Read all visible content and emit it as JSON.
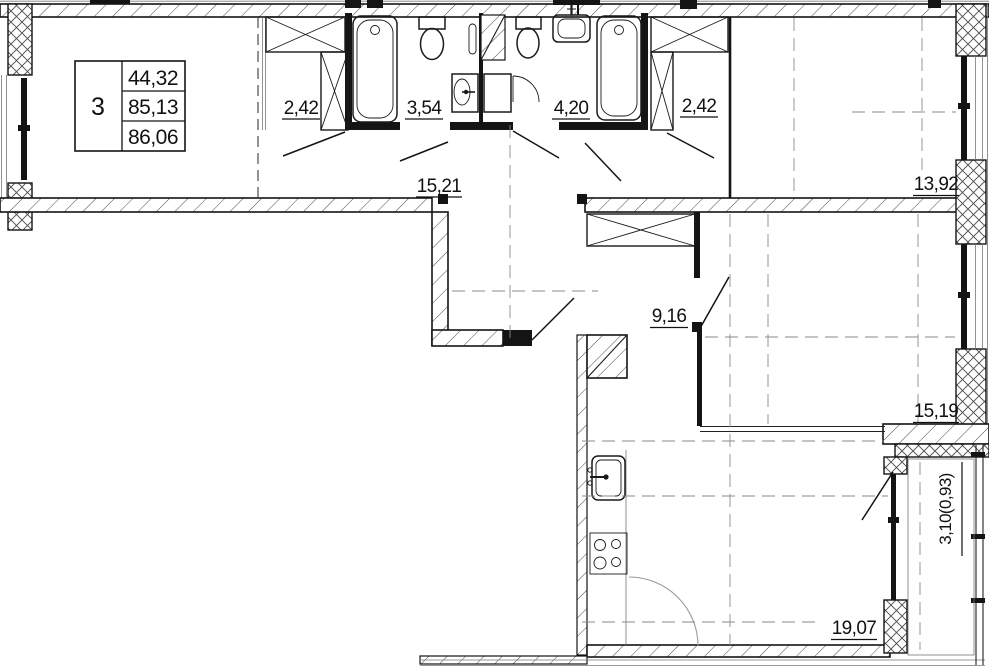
{
  "plan": {
    "info_table": {
      "room_count": "3",
      "living_area": "44,32",
      "apartment_area": "85,13",
      "total_area": "86,06"
    },
    "rooms": {
      "closet_left": "2,42",
      "bath_small": "3,54",
      "bath_large": "4,20",
      "closet_right": "2,42",
      "hall": "15,21",
      "room_top_right": "13,92",
      "corridor": "9,16",
      "room_right": "15,19",
      "balcony": "3,10(0,93)",
      "kitchen_living": "19,07"
    }
  }
}
